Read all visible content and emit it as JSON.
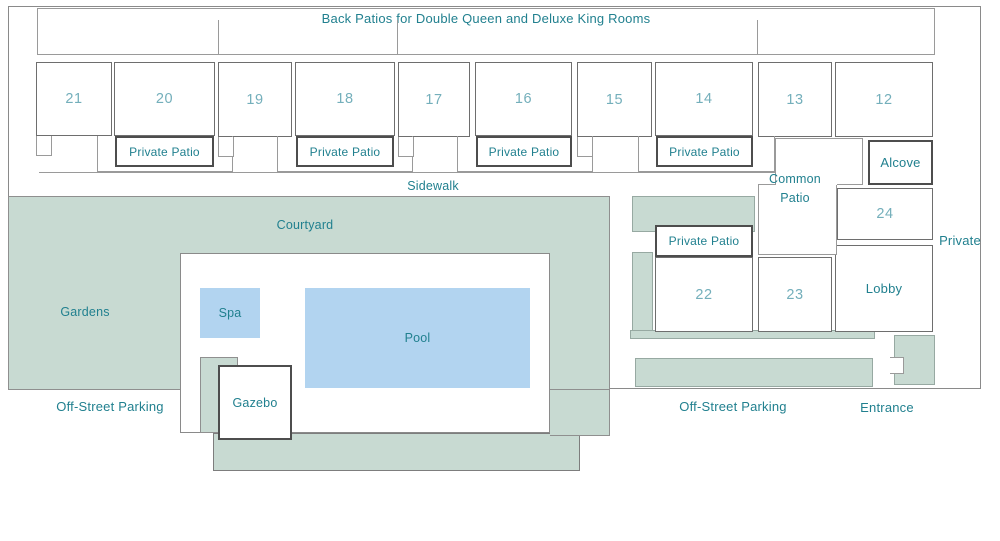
{
  "title": "Back Patios for Double Queen and Deluxe King Rooms",
  "rooms": {
    "top": [
      {
        "number": "21"
      },
      {
        "number": "20"
      },
      {
        "number": "19"
      },
      {
        "number": "18"
      },
      {
        "number": "17"
      },
      {
        "number": "16"
      },
      {
        "number": "15"
      },
      {
        "number": "14"
      },
      {
        "number": "13"
      },
      {
        "number": "12"
      }
    ],
    "side": [
      {
        "number": "22"
      },
      {
        "number": "23"
      },
      {
        "number": "24"
      }
    ]
  },
  "labels": {
    "private_patio": "Private Patio",
    "sidewalk": "Sidewalk",
    "courtyard": "Courtyard",
    "gardens": "Gardens",
    "spa": "Spa",
    "pool": "Pool",
    "gazebo": "Gazebo",
    "common_patio": "Common Patio",
    "alcove": "Alcove",
    "lobby": "Lobby",
    "private": "Private",
    "off_street_parking_left": "Off-Street Parking",
    "off_street_parking_right": "Off-Street Parking",
    "entrance": "Entrance"
  },
  "colors": {
    "ground_green": "#c8dad2",
    "water_blue": "#b2d4f0",
    "label_teal": "#21808f",
    "room_number_teal": "#74afbb",
    "border_gray": "#8a8a8a",
    "dark_border": "#4d4d4d"
  }
}
